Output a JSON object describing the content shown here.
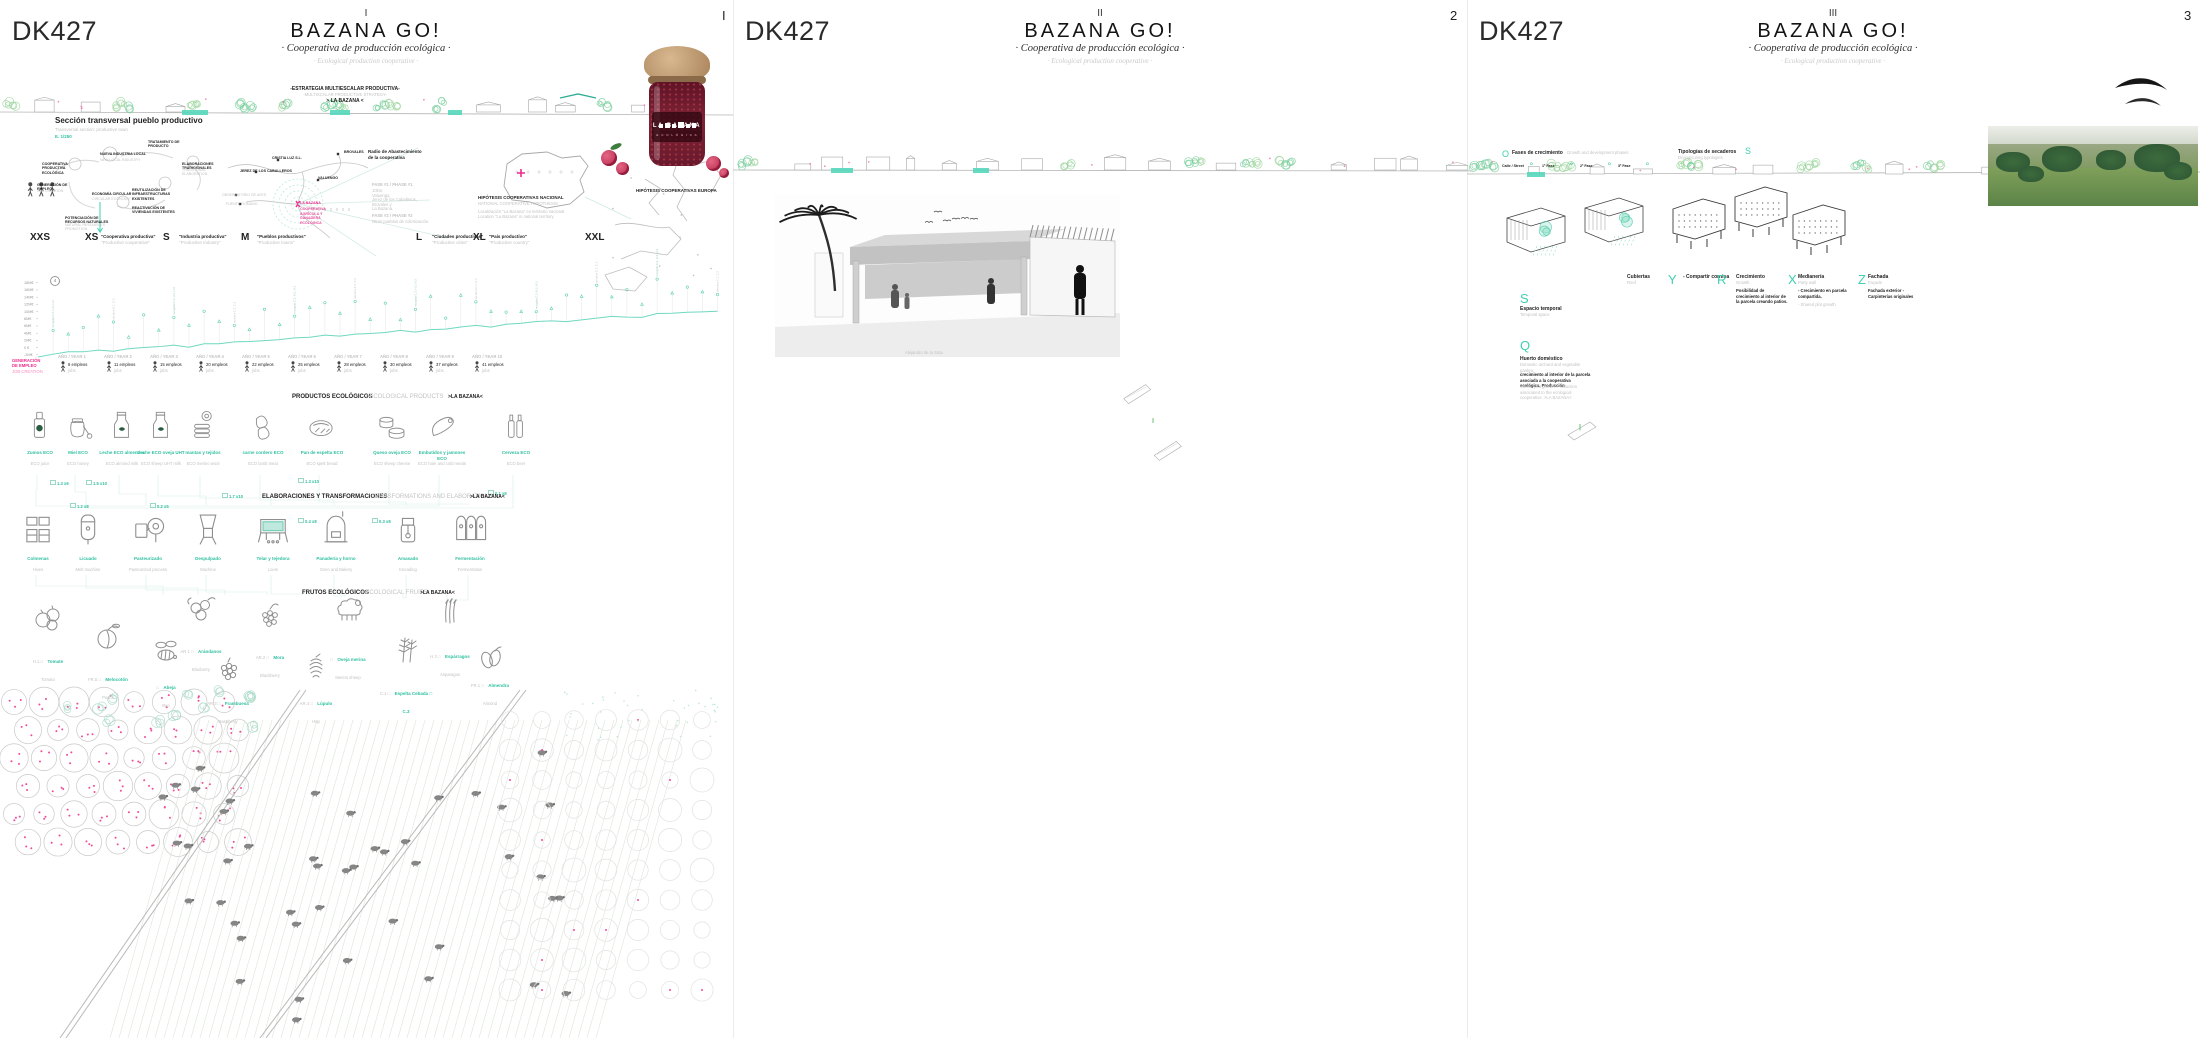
{
  "board": {
    "accent_teal": "#3ed0b0",
    "accent_pink": "#ef2a8b",
    "panels": [
      {
        "code": "DK427",
        "numeral": "I",
        "page": "I",
        "title": "BAZANA GO!",
        "subtitle_es": "· Cooperativa de producción ecológica ·",
        "subtitle_en": "· Ecological production cooperative ·"
      },
      {
        "code": "DK427",
        "numeral": "II",
        "page": "2",
        "title": "BAZANA GO!",
        "subtitle_es": "· Cooperativa de producción ecológica ·",
        "subtitle_en": "· Ecological production cooperative ·"
      },
      {
        "code": "DK427",
        "numeral": "III",
        "page": "3",
        "title": "BAZANA GO!",
        "subtitle_es": "· Cooperativa de producción ecológica ·",
        "subtitle_en": "· Ecological production cooperative ·"
      }
    ]
  },
  "panel1": {
    "section": {
      "es": "Sección transversal pueblo productivo",
      "en": "Transversal section: productive town",
      "scale": "E. 1/250"
    },
    "strategy": {
      "es": "-ESTRATEGIA MULTIESCALAR PRODUCTIVA-",
      "en": "-MULTISCALAR PRODUCTIVE STRATEGY-",
      "tag": "> LA BAZANA <"
    },
    "cycle": [
      "COOPERATIVA PRODUCTIVA ECOLÓGICA",
      "NUEVA INDUSTRIA LOCAL",
      "ELABORACIONES TRADICIONALES",
      "TRATAMIENTO DE PRODUCTO",
      "GENERACIÓN DE EMPLEO",
      "ECONOMÍA CIRCULAR",
      "REUTILIZACIÓN DE INFRAESTRUCTURAS EXISTENTES",
      "REACTIVACIÓN DE VIVIENDAS EXISTENTES",
      "POTENCIACIÓN DE RECURSOS NATURALES"
    ],
    "cycle_en": [
      "NEW LOCAL INDUSTRY",
      "TRADITIONAL ELABORATION",
      "JOB CREATION",
      "CIRCULAR ECONOMY",
      "NATURAL RESOURCES PROMOTION"
    ],
    "map": {
      "radius1": "Radio de Abastecimiento",
      "radius2": "de la cooperativa",
      "towns": [
        "CRISTIA LUZ S.L.",
        "BROVALES",
        "JEREZ DE LOS CABALLEROS",
        "VALUENGO",
        "OBSERVATORIO DE AVES",
        "FUENTE ROMANO"
      ],
      "bazana": "LA BAZANA",
      "bazana_sub": [
        "COOPERATIVA",
        "AGRÍCOLA Y",
        "GANADERA",
        "ECOLÓGICA"
      ],
      "fase1": "FASE #1  / PHASE #1",
      "fase1_lines": [
        "10km:",
        "Valuengo,",
        "Jerez de los Caballeros,",
        "Brovales y",
        "La Bazana."
      ],
      "fase2": "FASE #2  / PHASE #2",
      "fase2_line": "Otros pueblos de colonización.",
      "hip1": "HIPÓTESIS COOPERATIVAS NACIONAL",
      "hip1_en": "NATIONAL COOPERATIVE HYPOTHESIS",
      "hip1_note": "Localización \"La Bazana\" en territorio nacional",
      "hip1_note_en": "Location \"La Bazana\" in national territory",
      "hip2": "HIPÓTESIS COOPERATIVAS EUROPA"
    },
    "scales": [
      {
        "size": "XXS",
        "es": "",
        "en": ""
      },
      {
        "size": "XS",
        "es": "\"Cooperativa productiva\"",
        "en": "\"Productive cooperative\""
      },
      {
        "size": "S",
        "es": "\"Industria productiva\"",
        "en": "\"Productive Industry\""
      },
      {
        "size": "M",
        "es": "\"Pueblos productivos\"",
        "en": "\"Productive towns\""
      },
      {
        "size": "L",
        "es": "\"Ciudades productivas\"",
        "en": "\"Productive cities\""
      },
      {
        "size": "XL",
        "es": "\"País productivo\"",
        "en": "\"Productive country\""
      },
      {
        "size": "XXL",
        "es": "",
        "en": ""
      }
    ],
    "chart": {
      "yticks": [
        "18M€",
        "16M€",
        "14M€",
        "12M€",
        "10M€",
        "8M€",
        "6M€",
        "4M€",
        "2M€",
        "0 €",
        "-2M€"
      ],
      "years": [
        "AÑO / YEAR 1",
        "AÑO / YEAR 2",
        "AÑO / YEAR 3",
        "AÑO / YEAR 4",
        "AÑO / YEAR 5",
        "AÑO / YEAR 6",
        "AÑO / YEAR 7",
        "AÑO / YEAR 8",
        "AÑO / YEAR 9",
        "AÑO / YEAR 10"
      ],
      "jobs": [
        "8 empleos",
        "11 empleos",
        "15 empleos",
        "20 empleos",
        "22 empleos",
        "25 empleos",
        "28 empleos",
        "30 empleos",
        "37 empleos",
        "41 empleos"
      ],
      "jobs_en": "jobs",
      "legend1": "GENERACIÓN",
      "legend2": "DE EMPLEO",
      "legend3": "JOB CREATION",
      "tick_a": "recogida C.3, H.2, H.3",
      "tick_b": "siembra C.1, C.2"
    },
    "headers": {
      "products": "PRODUCTOS ECOLÓGICOS",
      "products_en": "/ ECOLOGICAL PRODUCTS",
      "elab": "ELABORACIONES Y  TRANSFORMACIONES",
      "elab_en": "/ TRANSFORMATIONS AND ELABORATIONS",
      "fruits": "FRUTOS ECOLÓGICOS",
      "fruits_en": "/ ECOLOGICAL FRUITS",
      "tag": ">LA BAZANA<"
    },
    "products": [
      {
        "es": "Zumos ECO",
        "en": "ECO juice"
      },
      {
        "es": "Miel ECO",
        "en": "ECO honey"
      },
      {
        "es": "Leche ECO almendra",
        "en": "ECO almond milk"
      },
      {
        "es": "Leche ECO oveja UHT",
        "en": "ECO sheep UHT milk"
      },
      {
        "es": "mantas y tejidos",
        "en": "ECO merino wool"
      },
      {
        "es": "carne cordero ECO",
        "en": "ECO lamb meat"
      },
      {
        "es": "Pan de espelta ECO",
        "en": "ECO spelt bread"
      },
      {
        "es": "Queso oveja ECO",
        "en": "ECO sheep cheese"
      },
      {
        "es": "Embutidos y jamones ECO",
        "en": "ECO ham and cold meats"
      },
      {
        "es": "Cerveza ECO",
        "en": "ECO beer"
      }
    ],
    "flows": [
      {
        "a": "1.3",
        "b": "x6"
      },
      {
        "a": "1.5",
        "b": "x10"
      },
      {
        "a": "1.2",
        "b": "x8"
      },
      {
        "a": "0.2",
        "b": "x5"
      },
      {
        "a": "1.7",
        "b": "x10"
      },
      {
        "a": "1.3",
        "b": "x10"
      },
      {
        "a": "0.4",
        "b": "x8"
      },
      {
        "a": "0.3",
        "b": "x8"
      },
      {
        "a": "0.1",
        "b": "x9"
      }
    ],
    "machines": [
      {
        "es": "Colmenas",
        "en": "Hives"
      },
      {
        "es": "Licuado",
        "en": "Melt machine"
      },
      {
        "es": "Pasteurizado",
        "en": "Pasteurized process"
      },
      {
        "es": "Despulpado",
        "en": "Machine"
      },
      {
        "es": "Telar y tejedora",
        "en": "Loom"
      },
      {
        "es": "Panadería y horno",
        "en": "Oven and Bakery"
      },
      {
        "es": "Amasado",
        "en": "Kneading"
      },
      {
        "es": "Fermentación",
        "en": "Fermentation"
      }
    ],
    "fruits": [
      {
        "code": "H.1 □",
        "es": "Tomate",
        "en": "Tomato"
      },
      {
        "code": "FR.5 □",
        "es": "Melocotón",
        "en": "Peach"
      },
      {
        "code": "□",
        "es": "Abeja",
        "en": "Bee"
      },
      {
        "code": "AR.1 □",
        "es": "Arándanos",
        "en": "Blueberry"
      },
      {
        "code": "AR.3 □",
        "es": "Frambuesa",
        "en": "Raspberry"
      },
      {
        "code": "AR.2 □",
        "es": "Mora",
        "en": "Blackberry"
      },
      {
        "code": "AR.4 □",
        "es": "Lúpulo",
        "en": "Hop"
      },
      {
        "code": "□",
        "es": "Oveja merina",
        "en": "Merino sheep"
      },
      {
        "code": "C.1 □",
        "es": "Espelta Cebada □ C.3",
        "en": ""
      },
      {
        "code": "H.3 □",
        "es": "Espárragos",
        "en": "Asparagus"
      },
      {
        "code": "FR.1 □",
        "es": "Almendra",
        "en": "Almond"
      }
    ]
  },
  "panel2": {
    "p1": {
      "tag": "P1",
      "title": "Plazas de/ of Alejandro de la Sota",
      "lines": [
        "5 Plazas / 5 squares",
        "Potenciar la identidad del espacio público",
        "Celebración de eventos",
        "asociados al pueblo: Fiesta de la chuleta, ..."
      ],
      "gray": [
        "Promote public space identity",
        "Events celebrations:",
        "\"Fiesta de la chuleta, Belén, ...\""
      ]
    },
    "p2": {
      "tag": "P2",
      "title": "Zócalos recuperados",
      "gray": "Recover traditional stucco"
    },
    "p3": {
      "tag": "P3",
      "title": "Estructura efímera",
      "gray": "Ephemeral structure",
      "l1": "Protección solar, Humidificadores",
      "l2": "integrados",
      "gray2": "Solar protection, Integrated humidifiers"
    },
    "p4": {
      "tag": "P4",
      "title": "Recuperación de fuentes",
      "gray": "Original fountain recover",
      "l1": "Conexión con el canal de agua",
      "gray2": "Agua canal connection"
    },
    "photo_caption": "Alejandro de la Sota",
    "side": [
      {
        "a": "Reutilización",
        "b": "del canal",
        "en": "Canal re-use"
      },
      {
        "a": "Fitodepuración",
        "b": "",
        "en": "Natural swimming pools"
      },
      {
        "a": "Espacios productivos y lúdicos",
        "b": "",
        "en": "Productive and ludic space"
      }
    ],
    "plus": "+",
    "canal_top": {
      "es": "Canal y piscinas naturales",
      "gray": "Anfiteatro"
    },
    "detail": {
      "t": "\"EN EL DETALLE\" . . . . . . . . . . . . . . .",
      "l1": "Dentro del paisaje.",
      "l2": "Arquitectura entre atmósferas acuáticas y paisajísticas",
      "en": "Inside landscape. Architecture into water and landscape atmospheres",
      "scale": "E. 1/250"
    },
    "intro": {
      "l1": "Marco al paisaje",
      "l2": "Oda al paisaje productivo",
      "l3": "y bucólico",
      "gray": "Productive and bucolic landscape ODE!!!",
      "l4": "Conexión paisaje y pueblo"
    },
    "columns": [
      {
        "letter": "A",
        "es": "Crecimientos urbanos",
        "en": "Urban growth",
        "body": "La última ampliación de la estructura urbana de la población genera una distorsión muy importante respecto a su …"
      },
      {
        "letter": "B",
        "es": "Residencia temporal",
        "en": "Temporal residence",
        "body": "Planteamos la reconversión de la vivienda del párroco, actualmente en desuso, en una residencia para los trabajadores …"
      },
      {
        "letter": "C",
        "es": "Anfiteatro",
        "en": "Amphitheater",
        "body": "El coso taurino es una instalación actualmente infrautilizada. Por ello, planteamos la integración de un graderío natural en el que poder celebrar …"
      },
      {
        "letter": "D",
        "es": "Fundación De La Sota",
        "en": "De La Sota Foundation",
        "body": "Con la intención de salvaguardar una de las viviendas originales de De La Sota, se propone albergar en ella el Museo y Fundación Alejandro De La Sota. Un lugar donde aprender sobre su obra, y sobre la historia de los pueblos de colonización extremeños."
      },
      {
        "letter": "H",
        "es": "Canal y piscinas naturales",
        "en": "Anfiteatro",
        "body": "Interponemos un \"límite\" entre la población y su valle, recuperando el antiguo canal de riego que pasaba junto a la población. Con ello, pretendemos contener el crecimiento de la ciudad hacia el valle, y potenciar el paisaje a través del disfrute de las aguas que circundan la población. Una sucesión de piscinas naturales, tratadas mediante procesos de fitodepuración, permiten la sucesión de acontecimientos a través de la cualidad de sus espacios."
      }
    ],
    "letterF": "F",
    "miradors": [
      {
        "letter": "E",
        "es": "Mirador de Méjico",
        "en": "Balcony \"De Méjico\""
      },
      {
        "letter": "G",
        "es": "Mirador del Perú",
        "en": "Balcony \"Del Perú\""
      }
    ],
    "axo": {
      "label": "AXONOMÉTRICA.",
      "scale": "E. 1/750"
    },
    "atm": {
      "l1": "Atmosphere #1",
      "l2": "Natural wimming pools view"
    }
  },
  "panel3": {
    "fases": {
      "letter": "O",
      "es": "Fases de crecimiento",
      "en": "Growth and development phases",
      "phases": [
        "Calle / Street",
        "1ª Fase",
        "2ª Fase",
        "3ª Fase"
      ]
    },
    "secaderos": {
      "letter": "S",
      "es": "Tipologías de secaderos",
      "en": "Drying/curing typologies"
    },
    "traits": [
      {
        "letter": "Y",
        "es": "Cubiertas",
        "en": "Roof",
        "note": "",
        "note_en": ""
      },
      {
        "letter": "R",
        "es": "- Compartir cornisa",
        "en": "",
        "note": "",
        "note_en": ""
      },
      {
        "letter": "X",
        "es": "Crecimiento",
        "en": "Growth",
        "note": "Posibilidad de crecimiento al interior de la parcela creando patios.",
        "note_en": ""
      },
      {
        "letter": "",
        "es": "Medianería",
        "en": "Party wall",
        "note": "- Crecimiento en parcela compartida.",
        "note_en": "- Shared plot growth"
      },
      {
        "letter": "Z",
        "es": "Fachada",
        "en": "Façade",
        "note": "Fachada exterior - Carpinterías originales",
        "note_en": ""
      }
    ],
    "sq": {
      "s": "S",
      "s_es": "Espacio temporal",
      "s_en": "Temporal space",
      "q": "Q",
      "q_es": "Huerto doméstico",
      "q_en": "Domestic orchard and vegetable garden",
      "q_note": "crecimiento al interior de la parcela asociada a la cooperativa ecológica. Producción",
      "q_note2": "asociada a la cooperativa ecológica de la Bazana",
      "q_note_en": "Interior plot growth. Production associated to the ecological cooperative. >LA BAZANA<"
    },
    "photo": {
      "parcela": "Parcela existente",
      "parcela_en": "Existing plot",
      "fach": "Fachada exterior",
      "fach2": "- Carpinterías originales",
      "from": "From 1954. . . . . . . . . . .",
      "till": "Till today ...",
      "atm1": "Atmosphere #1",
      "atm2": "Natural wimming pools view"
    },
    "columns": [
      {
        "letter": "i",
        "es": "Aprovechamiento agrícola",
        "en": "Agricultural use",
        "body": "Actualmente un terreno desaprovechado, con canalización de aguas cercanas y terreno fértil, sin utilidad ni rendimientos agrícolas. Se propone inicialmente su consolidación como terreno para implantar nuevas huertas. En un futuro muy lejano, proponemos su uso como crecimiento de suelo urbano."
      },
      {
        "letter": "J",
        "es": "Antigua Hermandad Sindical",
        "en": "",
        "body": "La antigua hermandad se ofrece como un lugar ideal para albergar las instalaciones destinadas a las transformaciones y elaboraciones de los productos ecológicos recogidos en La Bazana. Un lugar donde además tenga cabida lo espontáneo, volcado al patio central que articula la construcción: elaboración de los embutidos de la matanza, de tejidos, de platos tradicionales, etc."
      },
      {
        "letter": "M",
        "es": "Oficina Temporal Cooperativa",
        "en": "Cooperative Temporal Bureau",
        "body": "La última adición urbana a la población supone una perturbación del proyecto original de La Bazana. A día de hoy sin uso, proponemos su integración temporal en la red de edificios de la cooperativa, para albergar las oficinas. Estas serán las encargadas de gestionar, administrar y vender los productos de la cooperativa. Cuando los beneficios lo hagan factible, se recompondrá la volumetría e identidad original de esta parcela."
      },
      {
        "letter": "N",
        "es": "Bosque de los Álamos",
        "en": "Poplars' forest",
        "body": "Este bosque alude a los planteamientos de De La Sota: un pueblo escondido que se descubre al llegar a él. Con ello, tratamos de ocultar las franjas edificadas disonantes, y compaginar las piscinas con zonas de sombra."
      },
      {
        "letter": "O",
        "es": "Antiguos Almacenes",
        "en": "Old warehouses",
        "body": "Los antiguos almacenes se destinarán a los nuevos usos de la industria asociada al tratamiento y transformación de los frutos recogidos de las siembras: recepción de materias primas, cámaras de maduración, almacenaje, distribución, etc."
      },
      {
        "letter": "P",
        "es": "Depuración Aguas Negras",
        "en": "Water Treatment",
        "body": "En continuidad con el canal destinado al ocio, y aguas abajo, proponemos distintas piscinas destinadas a la depuración de aguas negras de la población. Ello nos permitiría limpiar el agua mediante procesos naturales, y evitar vertidos incontrolados al río."
      }
    ],
    "miradors": [
      {
        "letter": "L",
        "es": "Mirador del Pacífico",
        "en": "Balcony \"La Conquista\""
      },
      {
        "letter": "K",
        "es": "Mirador de la Florida",
        "en": "Balcony \"De la Florida\""
      }
    ],
    "conquista": {
      "letter": "L",
      "es": "Mirador de La Conquista",
      "en": "Balcony \"La Conquista\"",
      "poem": [
        "Los álamos de plata",
        "se inclinan sobre el agua,",
        "ellos todo lo saben,",
        "pero nunca hablarán."
      ],
      "attr": "F. García Lorca. Los álamos de Plata. Libro de Poemas, 1921.",
      "body": "Entre álamos de plata, sol y sombra pendiente del viento, se abre el primer mirador hacia el valle: la conquista."
    },
    "ampliaciones": {
      "es": "Ampliaciones futuras",
      "en": "Future ampliation"
    }
  }
}
